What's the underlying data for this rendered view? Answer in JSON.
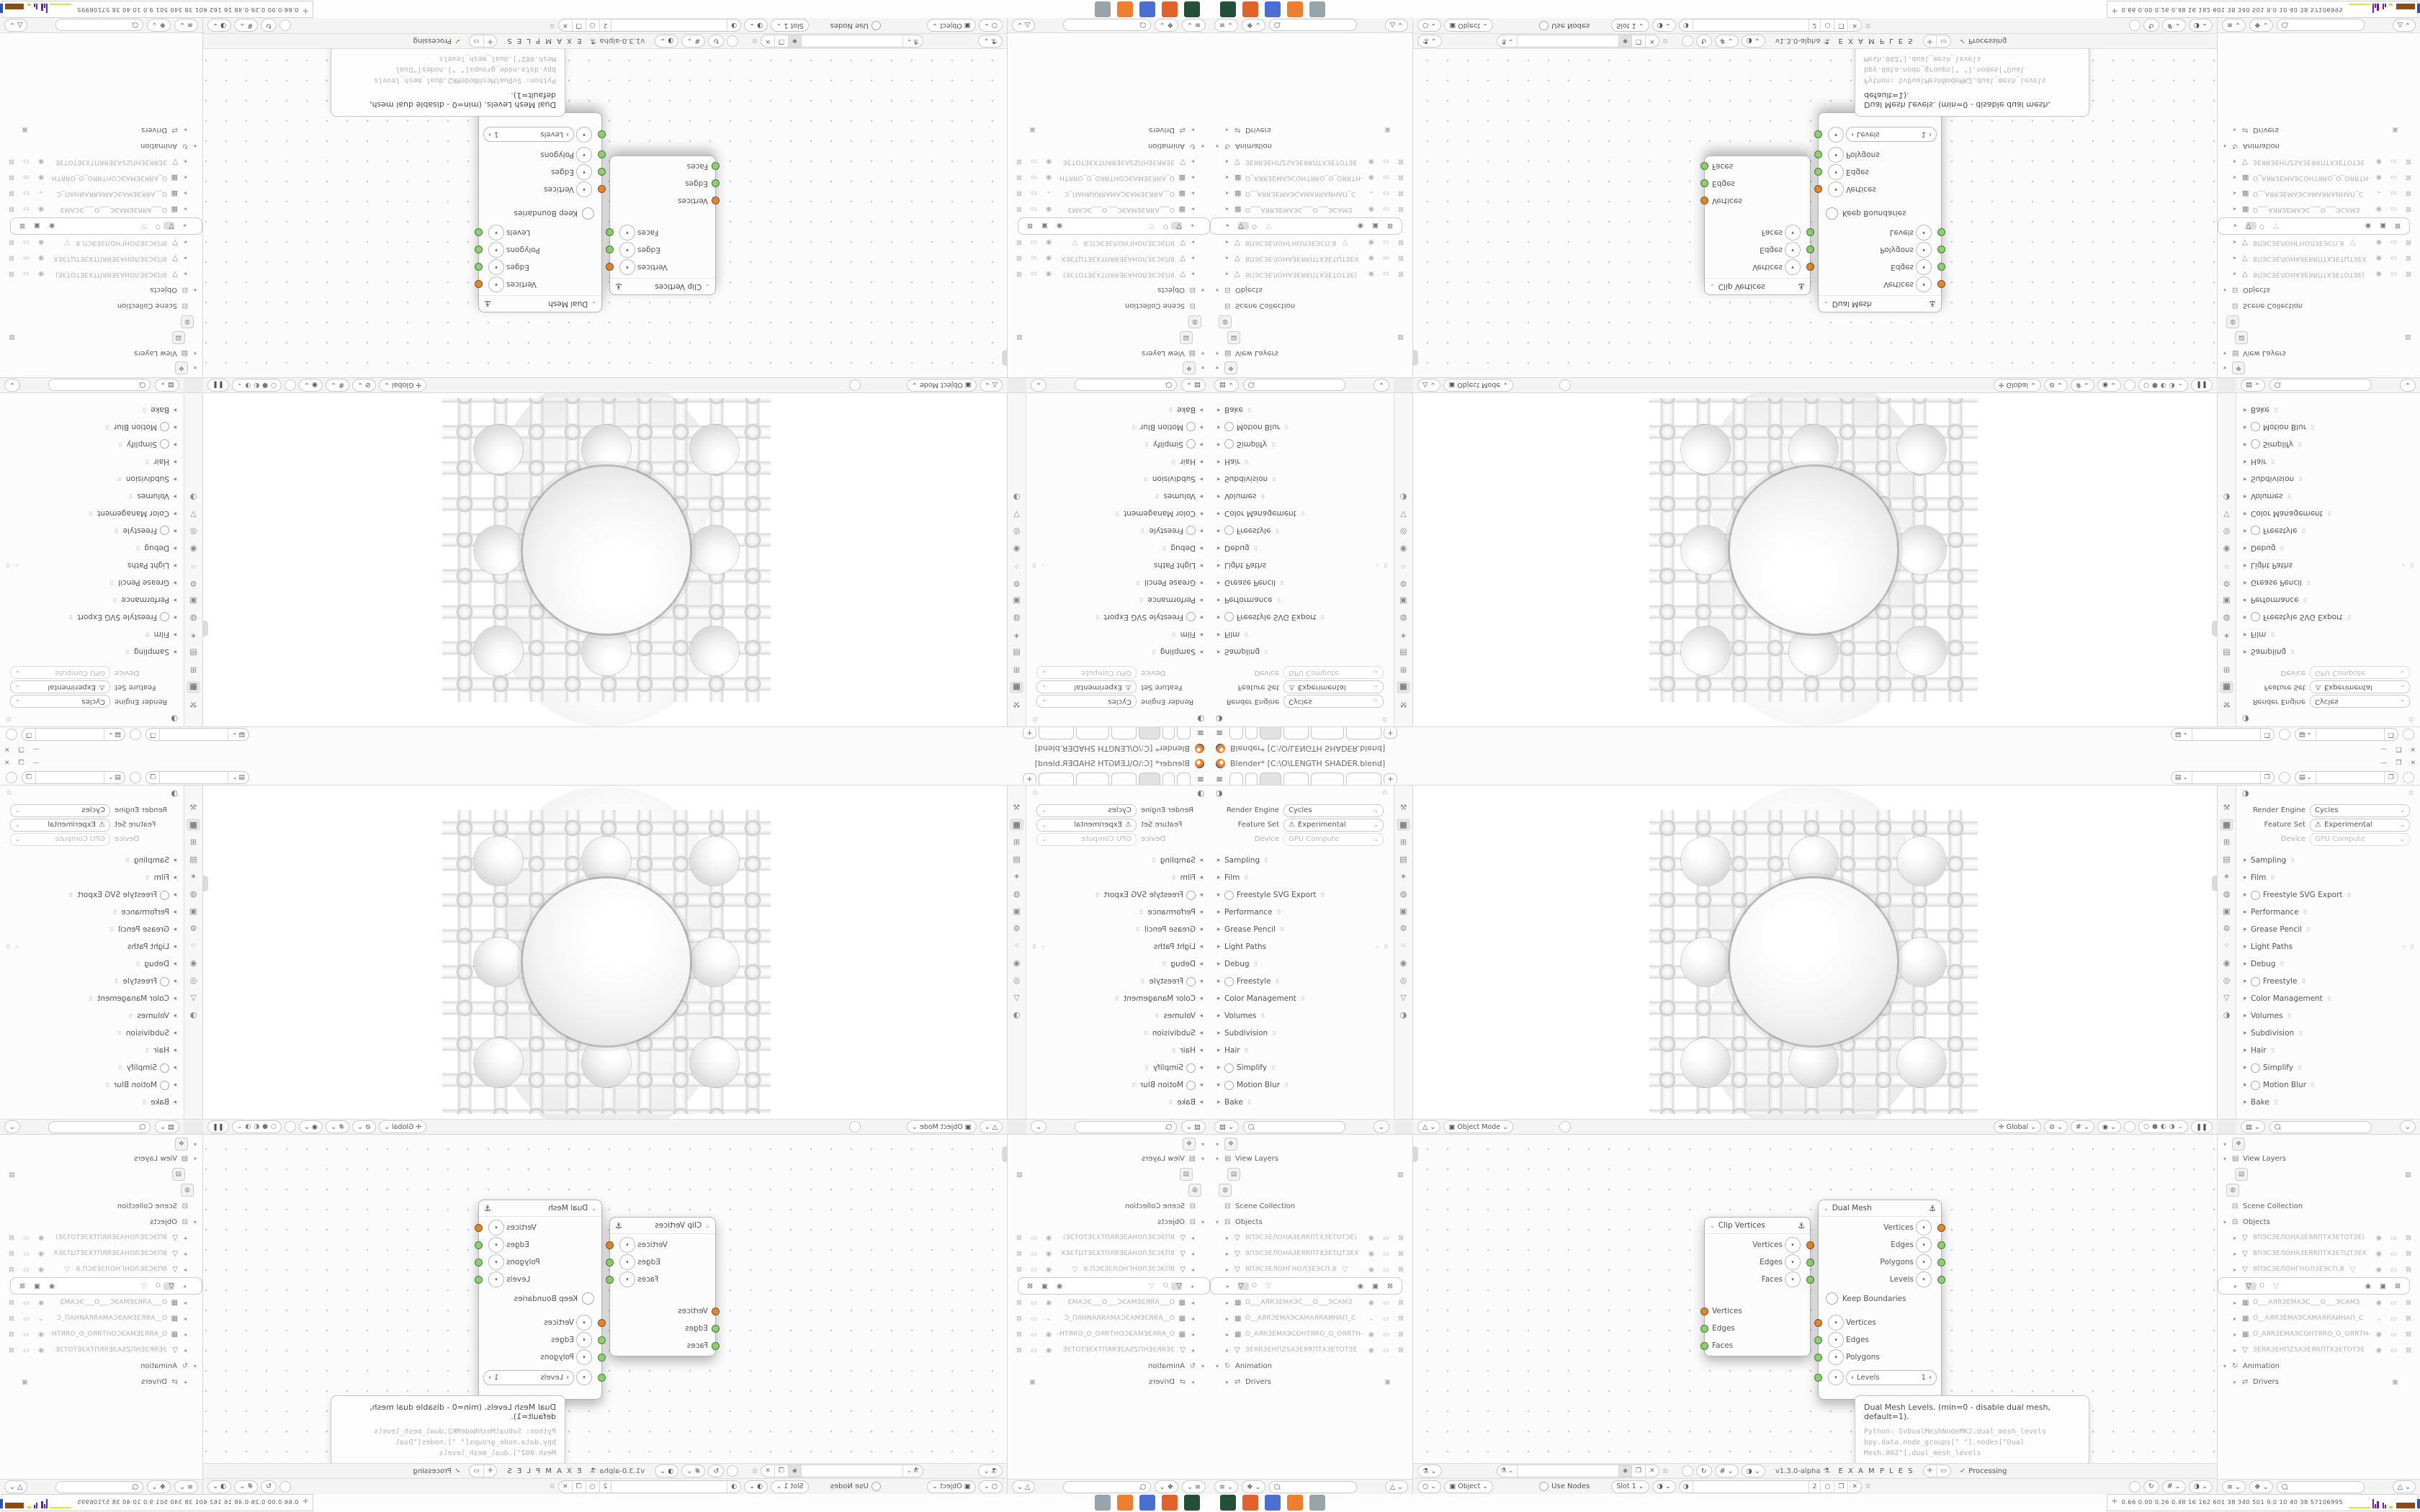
{
  "window": {
    "title": "Blender* [C:\\O\\LENGTH SHADER.blend]"
  },
  "icons": {
    "menu": "≡",
    "plus": "+",
    "chev": "⌄",
    "tri_r": "▸",
    "tri_d": "▾",
    "close": "✕",
    "min": "—",
    "max": "❐",
    "pin": "☆",
    "anchor": "⚓",
    "dna": "⚗",
    "warn": "⚠",
    "radio": "○",
    "check": "✓",
    "copy": "❐",
    "shield": "◈",
    "gm": "△",
    "propsel": "▤",
    "sphere": "◑",
    "grid": "#",
    "snap": "↻",
    "pause": "❚❚",
    "left": "‹",
    "right": "›",
    "collection": "⊟",
    "vlayer": "▤",
    "cam": "▦",
    "globe": "◍",
    "person": "❖",
    "anim": "↻",
    "drv": "⇄",
    "box": "▣",
    "stat": "✛",
    "global": "✛",
    "magnet": "⊘",
    "outsel": "≡",
    "shade0": "○",
    "shade1": "●",
    "shade2": "◐",
    "shade3": "◑",
    "eye": "◉",
    "scr": "▭",
    "camx": "⊠",
    "obj": "▣"
  },
  "topbar": {
    "tabs": [
      {
        "w": 17
      },
      {
        "w": 15
      },
      {
        "w": 28,
        "cls": "active"
      },
      {
        "w": 33
      },
      {
        "w": 44
      },
      {
        "w": 47
      }
    ],
    "scene_field": "",
    "viewlayer_field": ""
  },
  "props": {
    "render_engine_label": "Render Engine",
    "render_engine": "Cycles",
    "feature_set_label": "Feature Set",
    "feature_set": "Experimental",
    "device_label": "Device",
    "device": "GPU Compute",
    "sections": [
      {
        "label": "Sampling"
      },
      {
        "label": "Film"
      },
      {
        "label": "Freestyle SVG Export",
        "toggle": true
      },
      {
        "label": "Performance"
      },
      {
        "label": "Grease Pencil"
      },
      {
        "label": "Light Paths",
        "extra": true
      },
      {
        "label": "Debug"
      },
      {
        "label": "Freestyle",
        "toggle": true
      },
      {
        "label": "Color Management"
      },
      {
        "label": "Volumes"
      },
      {
        "label": "Subdivision"
      },
      {
        "label": "Hair"
      },
      {
        "label": "Simplify",
        "toggle": true
      },
      {
        "label": "Motion Blur",
        "toggle": true
      },
      {
        "label": "Bake"
      }
    ],
    "tab_icons": [
      {
        "g": "⚒"
      },
      {
        "g": "▦",
        "cls": "on"
      },
      {
        "g": "⊞"
      },
      {
        "g": "▤"
      },
      {
        "g": "✶"
      },
      {
        "g": "◍"
      },
      {
        "g": "▣"
      },
      {
        "g": "⚙"
      },
      {
        "g": "⁘"
      },
      {
        "g": "◉"
      },
      {
        "g": "◎"
      },
      {
        "g": "▽"
      },
      {
        "g": "◑"
      }
    ]
  },
  "viewport": {
    "mode": "Object Mode",
    "menus": [
      "View",
      "Select",
      "Add",
      "Object"
    ],
    "orientation": "Global"
  },
  "outliner": {
    "view_layers": "View Layers",
    "scene_collection": "Scene Collection",
    "objects": "Objects",
    "animation": "Animation",
    "drivers": "Drivers",
    "rows": [
      {
        "t": "▽",
        "name": "8ПЭСЗЕЛОНАЗЕЯRПТХЗЕТОТЗЕ)",
        "mid": "",
        "i1": "◉",
        "i2": "▭",
        "i3": "⊠"
      },
      {
        "t": "▽",
        "name": "8ПЭСЗЕЛОНАЗЕЯRПТХЗЕТЦТЗЕХ",
        "mid": "",
        "i1": "◉",
        "i2": "▭",
        "i3": "⊠"
      },
      {
        "t": "▽",
        "name": "8ПЭСЗЕЛОНГНОЛЗЕЭСП.8",
        "mid": "▽",
        "i1": "◉",
        "i2": "▭",
        "i3": "⊠"
      },
      {
        "t": "▽",
        "name": "O",
        "mid": "▽",
        "i1": "◉",
        "i2": "▣",
        "i3": "⊠",
        "cls": "sel"
      },
      {
        "t": "▦",
        "name": "O___АЯRЗЕМАЭС___O___ЭСАМЗ",
        "mid": "",
        "i1": "◉",
        "i2": "▭",
        "i3": "⊠"
      },
      {
        "t": "▦",
        "name": "O__АЯRЗЕМАЭСАМАЯRАИНАП_С",
        "mid": "",
        "i1": "⌄",
        "i2": "▭",
        "i3": "⊠"
      },
      {
        "t": "▦",
        "name": "O_АЯRЗЕМАЭСОНТЯRО_O_ОЯRТН-",
        "mid": "",
        "i1": "◉",
        "i2": "▭",
        "i3": "⊠"
      },
      {
        "t": "▽",
        "name": "ЗЕЯRЗЕНПZSАЗЕЯRПТХЗЕТОТЗЕ",
        "mid": "",
        "i1": "◉",
        "i2": "▭",
        "i3": "⊠"
      }
    ]
  },
  "node_editor": {
    "menus": [
      "View",
      "Select",
      "Add",
      "Node"
    ],
    "tree_field": "",
    "version": "v1.3.0-alpha",
    "examples": "E X A M P L E S",
    "processing": "Processing",
    "clip_node": {
      "title": "Clip Vertices",
      "out0": "Vertices",
      "out1": "Edges",
      "out2": "Faces",
      "in0": "Vertices",
      "in1": "Edges",
      "in2": "Faces"
    },
    "dual_node": {
      "title": "Dual Mesh",
      "out0": "Vertices",
      "out1": "Edges",
      "out2": "Polygons",
      "out3": "Levels",
      "keep_boundaries": "Keep Boundaries",
      "in0": "Vertices",
      "in1": "Edges",
      "in2": "Polygons",
      "levels_label": "Levels",
      "levels_value": "1"
    },
    "tooltip": {
      "line1": "Dual Mesh Levels. (min=0 - disable dual mesh, default=1).",
      "line2": "Python: SvDualMeshNodeMK2.dual_mesh_levels",
      "line3": "bpy.data.node_groups[\" \"].nodes[\"Dual Mesh.002\"].dual_mesh_levels"
    }
  },
  "shader_editor": {
    "object": "Object",
    "menus": [
      "View",
      "Select",
      "Add",
      "Node"
    ],
    "use_nodes": "Use Nodes",
    "slot": "Slot 1",
    "mat_field": "",
    "users_count": "2"
  },
  "statusbar": {
    "stats": "0.66 0.00 0.26 0.48  16  162  601  38  340  501  9.0  10  40  38  57106995",
    "bars": [
      {
        "w": 30,
        "h": 2,
        "c": "#e6e23c",
        "mr": 2
      },
      {
        "w": 2,
        "h": 13,
        "c": "#6d1f9e"
      },
      {
        "w": 2,
        "h": 6,
        "c": "#6d1f9e"
      },
      {
        "w": 3,
        "h": 10,
        "c": "#6d1f9e",
        "mr": 4
      },
      {
        "w": 2,
        "h": 8,
        "c": "#6d1f9e"
      },
      {
        "w": 2,
        "h": 5,
        "c": "#6d1f9e",
        "mr": 3
      },
      {
        "w": 5,
        "h": 3,
        "c": "#d6d63a",
        "mr": 4
      },
      {
        "w": 26,
        "h": 8,
        "c": "#8a4a1a",
        "mr": 2
      },
      {
        "w": 30,
        "h": 13,
        "c": "#2a52b0",
        "mr": 2
      },
      {
        "w": 24,
        "h": 9,
        "c": "#8a4a1a",
        "mr": 4
      },
      {
        "w": 20,
        "h": 2,
        "c": "#49b340",
        "mr": 3
      },
      {
        "w": 2,
        "h": 6,
        "c": "#c0302a"
      },
      {
        "w": 2,
        "h": 4,
        "c": "#c0302a",
        "mr": 1
      },
      {
        "w": 13,
        "h": 2,
        "c": "#8e1414"
      }
    ]
  },
  "taskbar": {
    "tiles": [
      {
        "c": "#24503a"
      },
      {
        "c": "#e2622e"
      },
      {
        "c": "#4a6fd0"
      },
      {
        "c": "#ee7f2e"
      },
      {
        "c": "#99a3ab"
      }
    ]
  },
  "colors": {
    "socket_orange": "#e0862c",
    "socket_green": "#8ad06e",
    "accent": "#f07f2e"
  }
}
